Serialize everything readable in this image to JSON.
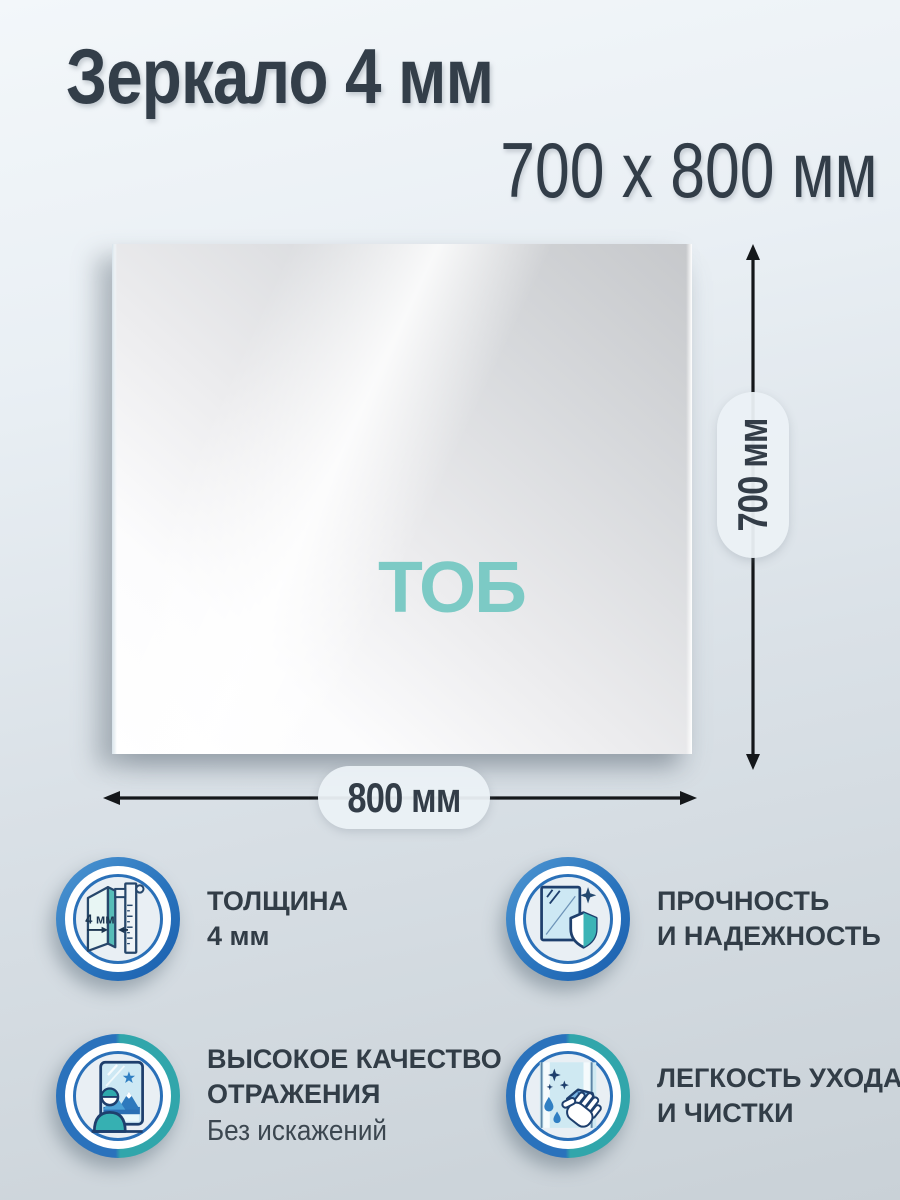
{
  "header": {
    "title": "Зеркало 4 мм",
    "size_line": "700 х 800 мм"
  },
  "mirror": {
    "logo_text": "ТОБ"
  },
  "dimensions": {
    "height": "700 мм",
    "width": "800 мм"
  },
  "features": [
    {
      "id": "thickness",
      "icon": "caliper-icon",
      "icon_label": "4 мм",
      "title_lines": [
        "ТОЛЩИНА",
        "4 мм"
      ]
    },
    {
      "id": "strength",
      "icon": "mirror-shield-icon",
      "title_lines": [
        "ПРОЧНОСТЬ",
        "И НАДЕЖНОСТЬ"
      ]
    },
    {
      "id": "reflection-quality",
      "icon": "person-mirror-icon",
      "title_lines": [
        "ВЫСОКОЕ КАЧЕСТВО",
        "ОТРАЖЕНИЯ"
      ],
      "note": "Без искажений"
    },
    {
      "id": "easy-cleaning",
      "icon": "hand-cloth-icon",
      "title_lines": [
        "ЛЕГКОСТЬ УХОДА",
        "И ЧИСТКИ"
      ]
    }
  ],
  "colors": {
    "accent_teal": "#7ccac5",
    "badge_blue": "#2a74bd",
    "badge_teal": "#31a6ab",
    "text_dark": "#333e49",
    "arrow_black": "#14171a",
    "pill_bg": "#ebf1f5"
  }
}
